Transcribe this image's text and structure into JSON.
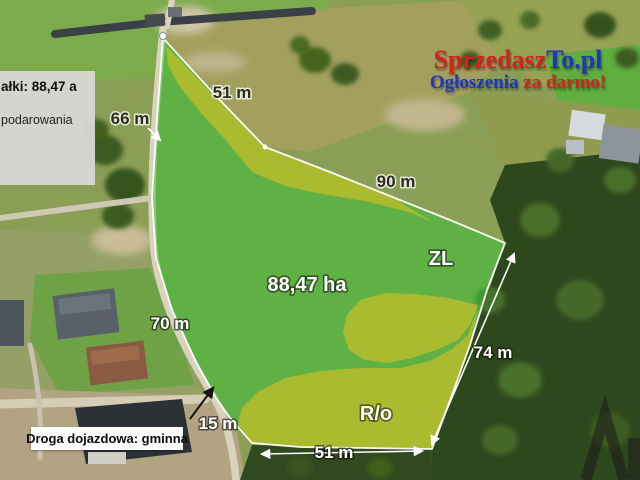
{
  "brand": {
    "name_red": "Sprzedasz",
    "name_blue": "To.pl",
    "tagline_blue": "Ogłoszenia",
    "tagline_red": " za darmo!",
    "red": "#d1241b",
    "blue": "#1f35c4"
  },
  "info_panel": {
    "line1": "ałki: 88,47 a",
    "line2": "podarowania"
  },
  "road_panel": {
    "label": "Droga dojazdowa: gminna"
  },
  "plot": {
    "area": "88,47 ha",
    "zone_forest": "ZL",
    "zone_agri": "R/o",
    "m_top": "51 m",
    "m_left": "66 m",
    "m_upper_right": "90 m",
    "m_road": "70 m",
    "m_east": "74 m",
    "m_bottom_left": "15 m",
    "m_bottom": "51 m"
  },
  "colors": {
    "plot_green": "#35c435",
    "zone_yellow": "#d8c222",
    "boundary_white": "#ffffff"
  }
}
